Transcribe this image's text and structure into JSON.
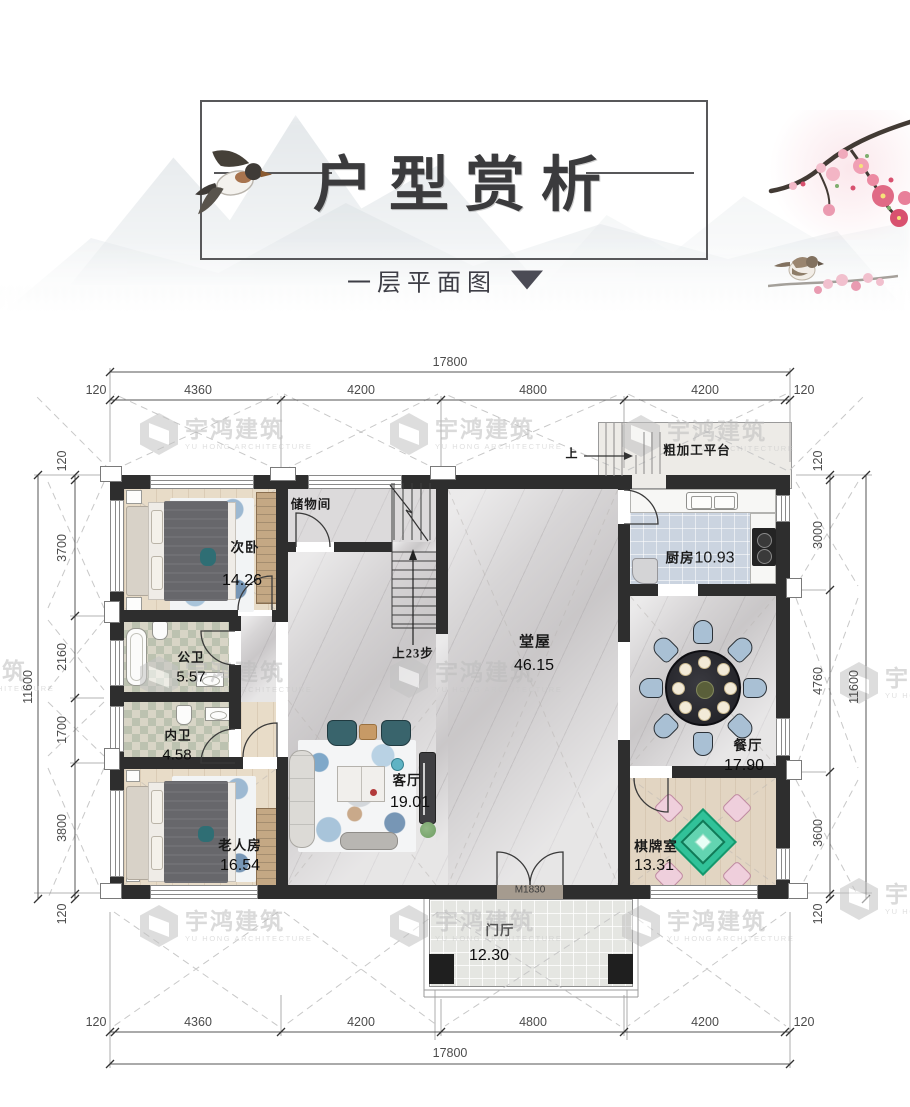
{
  "title": "户型赏析",
  "subtitle": "一层平面图",
  "watermark": {
    "name": "宇鸿建筑",
    "sub": "YU HONG ARCHITECTURE"
  },
  "plan": {
    "dims": {
      "top_total": "17800",
      "top_segments": [
        "120",
        "4360",
        "4200",
        "4800",
        "4200",
        "120"
      ],
      "bottom_total": "17800",
      "bottom_segments": [
        "120",
        "4360",
        "4200",
        "4800",
        "4200",
        "120"
      ],
      "left_total": "11600",
      "left_segments": [
        "120",
        "3700",
        "2160",
        "1700",
        "3800",
        "120"
      ],
      "right_total": "11600",
      "right_segments": [
        "120",
        "3000",
        "4760",
        "3600",
        "120"
      ]
    },
    "rooms": {
      "bedroom2": {
        "label": "次卧",
        "area": "14.26"
      },
      "storage": {
        "label": "储物间",
        "area": ""
      },
      "kitchen": {
        "label": "厨房",
        "area": "10.93"
      },
      "hall": {
        "label": "堂屋",
        "area": "46.15"
      },
      "bath_public": {
        "label": "公卫",
        "area": "5.57"
      },
      "bath_inner": {
        "label": "内卫",
        "area": "4.58"
      },
      "living": {
        "label": "客厅",
        "area": "19.01"
      },
      "dining": {
        "label": "餐厅",
        "area": "17.90"
      },
      "elder": {
        "label": "老人房",
        "area": "16.54"
      },
      "chess": {
        "label": "棋牌室",
        "area": "13.31"
      },
      "foyer": {
        "label": "门厅",
        "area": "12.30"
      },
      "platform": {
        "label": "粗加工平台",
        "area": ""
      }
    },
    "notes": {
      "stairs": "上23步",
      "entry_door": "M1830",
      "platform_up": "上"
    },
    "palette": {
      "wall": "#2e2e2e",
      "wood_floor": "#e8dcc8",
      "marble_floor": "#d7d5d6",
      "kitchen_tile": "#cbd4e0",
      "bath_tile": "#bcc2b0",
      "mahjong_table_green": "#31c299",
      "chair_pink": "#efcfdc",
      "dining_chair_blue": "#a9c0d4",
      "sofa_teal": "#39646c",
      "blossom_pink": "#e87a92"
    }
  }
}
